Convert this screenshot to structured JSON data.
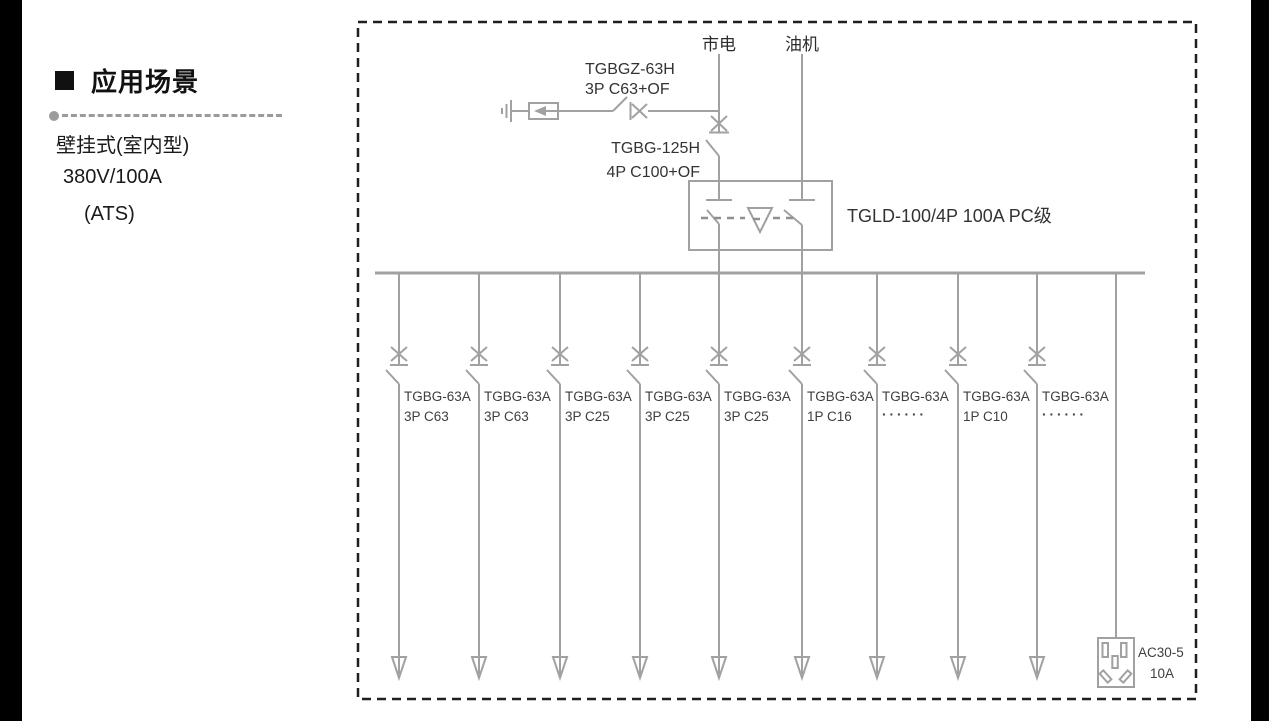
{
  "left_panel": {
    "title": "应用场景",
    "lines": [
      "壁挂式(室内型)",
      "380V/100A",
      "(ATS)"
    ]
  },
  "diagram": {
    "colors": {
      "line": "#a1a1a1",
      "border": "#1f1f1f",
      "label_text": "#3e3e3e"
    },
    "sources": {
      "mains": "市电",
      "generator": "油机"
    },
    "spd_branch": {
      "model": "TGBGZ-63H",
      "spec": "3P C63+OF"
    },
    "main_breaker": {
      "model": "TGBG-125H",
      "spec": "4P C100+OF"
    },
    "ats": {
      "label": "TGLD-100/4P 100A PC级"
    },
    "branches": [
      {
        "model": "TGBG-63A",
        "spec": "3P C63"
      },
      {
        "model": "TGBG-63A",
        "spec": "3P C63"
      },
      {
        "model": "TGBG-63A",
        "spec": "3P C25"
      },
      {
        "model": "TGBG-63A",
        "spec": "3P C25"
      },
      {
        "model": "TGBG-63A",
        "spec": "3P C25"
      },
      {
        "model": "TGBG-63A",
        "spec": "1P C16"
      },
      {
        "model": "TGBG-63A",
        "spec": "······"
      },
      {
        "model": "TGBG-63A",
        "spec": "1P C10"
      },
      {
        "model": "TGBG-63A",
        "spec": "······"
      }
    ],
    "socket": {
      "model": "AC30-5",
      "rating": "10A"
    }
  }
}
